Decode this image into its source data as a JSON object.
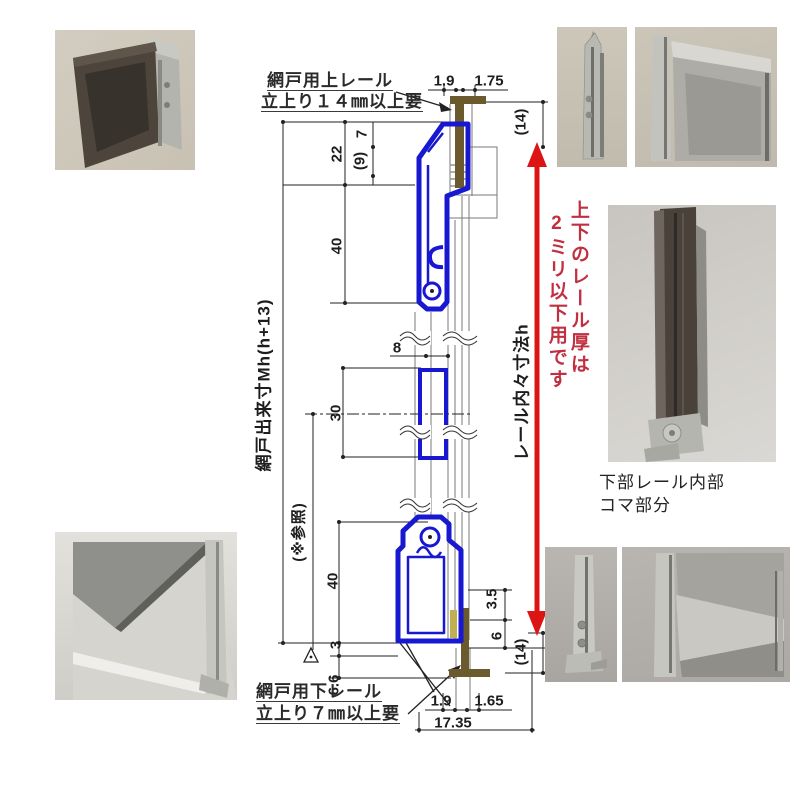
{
  "annotations": {
    "top_rail": {
      "line1": "網戸用上レール",
      "line2": "立上り１４㎜以上要"
    },
    "bottom_rail": {
      "line1": "網戸用下レール",
      "line2": "立上り７㎜以上要"
    },
    "screen_height": "網戸出来寸Mh(h+13)",
    "reference": "(※参照)",
    "rail_inner_height": "レール内々寸法h",
    "red_note": {
      "line1": "上下のレール厚は",
      "line2": "2ミリ以下用です"
    },
    "photo_caption": {
      "line1": "下部レール内部",
      "line2": "コマ部分"
    }
  },
  "dimensions": {
    "top_left_width": "1.9",
    "top_right_width": "1.75",
    "top_clearance": "(14)",
    "d7": "7",
    "d9": "(9)",
    "d22": "22",
    "d40_top": "40",
    "d8": "8",
    "d30": "30",
    "d40_bottom": "40",
    "d3": "3",
    "d6_6": "6.6",
    "d3_5": "3.5",
    "d6": "6",
    "bottom_clearance": "(14)",
    "bottom_left_width": "1.9",
    "bottom_right_width": "1.65",
    "bottom_total_width": "17.35"
  },
  "colors": {
    "profile_blue": "#1718cf",
    "rail_brown": "#6b5a2e",
    "arrow_red": "#dd1414",
    "note_red": "#c03040",
    "dim_line": "#222222"
  }
}
